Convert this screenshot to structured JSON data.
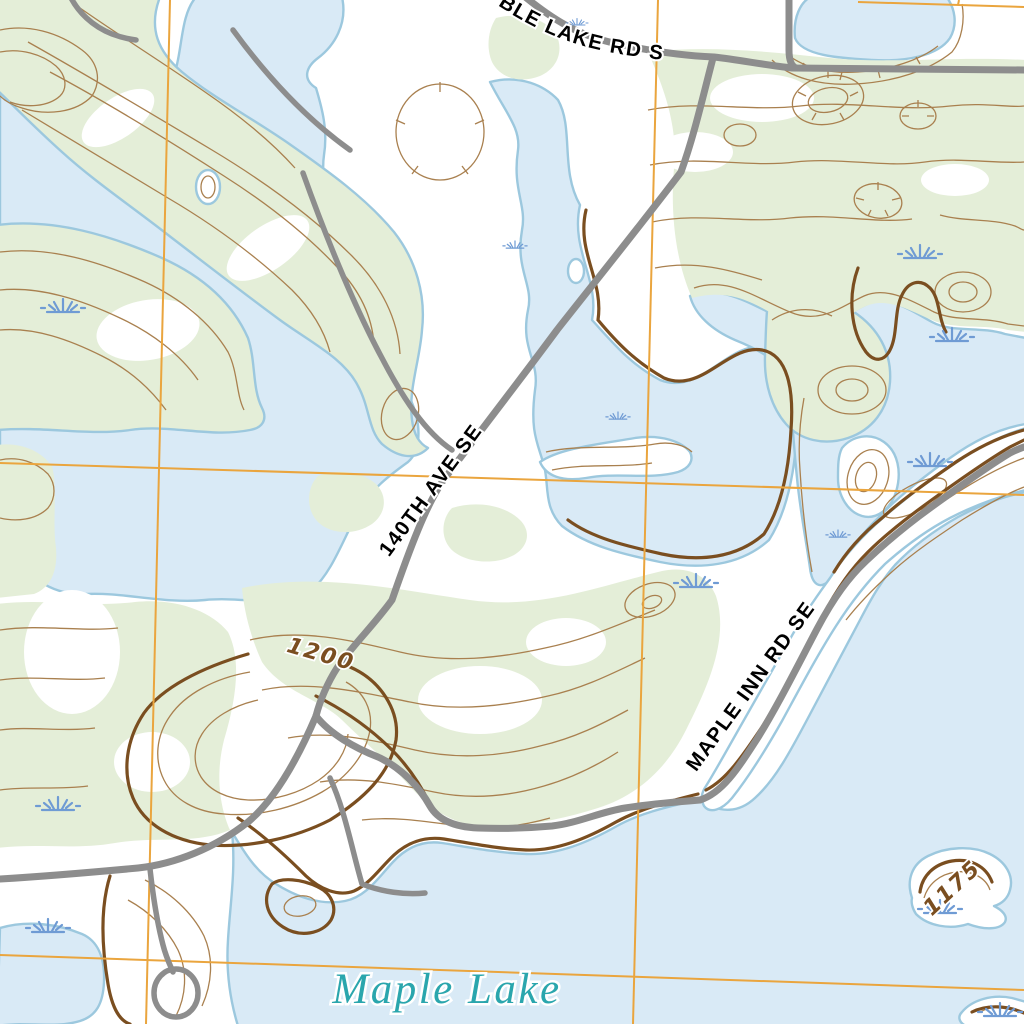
{
  "map": {
    "type": "topographic-map",
    "labels": {
      "road_top": "BLE LAKE RD S",
      "road_diagonal": "140TH AVE SE",
      "road_shore": "MAPLE INN RD SE",
      "lake_name": "Maple Lake",
      "contour_1200": "1200",
      "contour_1175": "1175"
    },
    "contour_elevations": [
      "1200",
      "1175"
    ],
    "icons": {
      "marsh": "marsh-grass-icon"
    },
    "colors": {
      "water_fill": "#d9eaf6",
      "water_edge": "#9cc8de",
      "vegetation": "#e4eed8",
      "contour": "#a9804f",
      "index_contour": "#7a4e20",
      "road": "#8d8d8d",
      "grid": "#eaa53e",
      "marsh": "#6f9bd4",
      "road_label": "#000000",
      "lake_label": "#2aa6ad"
    }
  }
}
